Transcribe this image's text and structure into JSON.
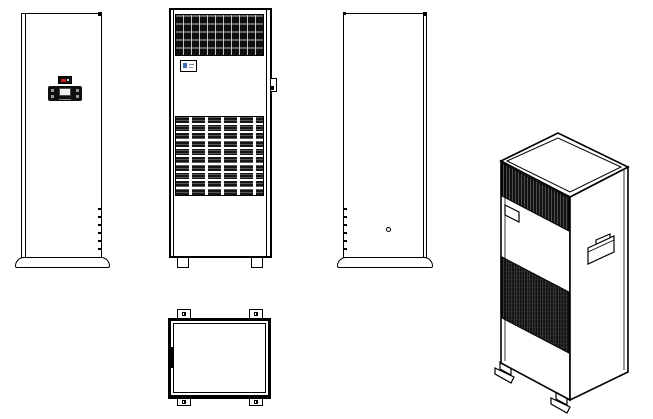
{
  "palette": {
    "line": "#000000",
    "background": "#ffffff",
    "grille_dark": "#101010",
    "grille_highlight": "#e1e1e1",
    "controller_body": "#0f0f0f",
    "controller_screen": "#f2f2f2",
    "display_indicator_red": "#c41f1f",
    "brand_label_blue": "#3f6cb4"
  },
  "views": {
    "front_panel_view": {
      "hinge_ticks": 6,
      "controller": {
        "side_buttons_left": 2,
        "side_buttons_right": 2
      },
      "display_unit": {
        "indicator_color": "#c41f1f"
      }
    },
    "front_grille_view": {
      "feet": 2,
      "label_badge": {
        "accent_color": "#3f6cb4"
      }
    },
    "side_view": {
      "hinge_ticks": 6,
      "drain_holes": 1
    },
    "top_view": {
      "corner_mounting_tabs": 4,
      "latch_marks": 1
    },
    "isometric_view": {
      "handles": 1,
      "feet": 2,
      "grilles": 2
    }
  }
}
